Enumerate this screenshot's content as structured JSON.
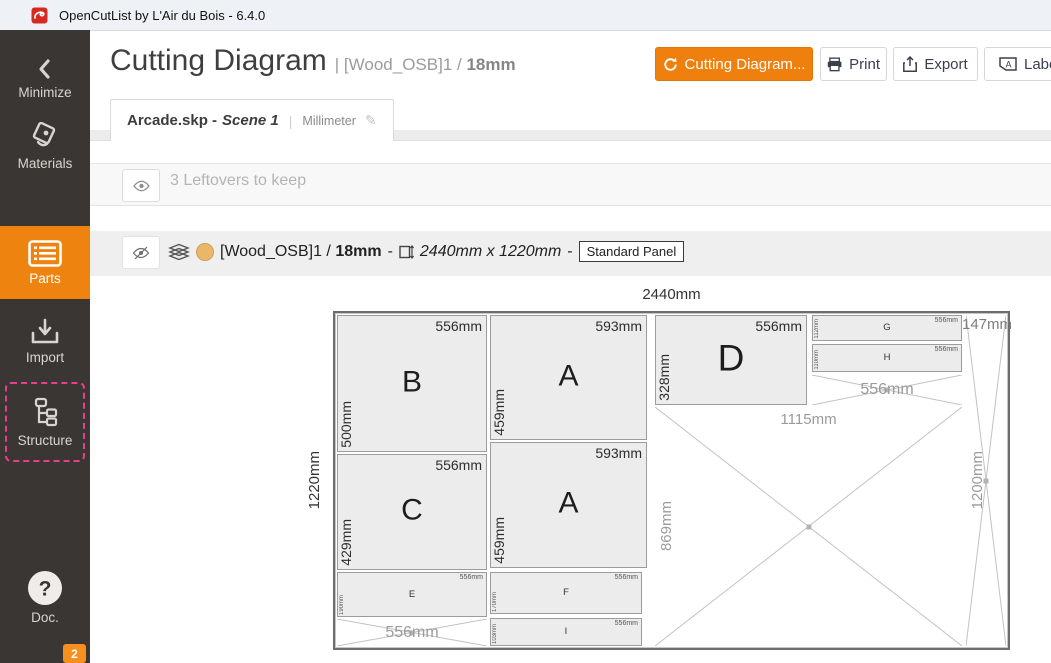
{
  "window": {
    "title": "OpenCutList by L'Air du Bois - 6.4.0"
  },
  "sidebar": {
    "items": [
      {
        "id": "minimize",
        "label": "Minimize"
      },
      {
        "id": "materials",
        "label": "Materials"
      },
      {
        "id": "parts",
        "label": "Parts"
      },
      {
        "id": "import",
        "label": "Import"
      },
      {
        "id": "structure",
        "label": "Structure"
      },
      {
        "id": "doc",
        "label": "Doc."
      }
    ],
    "badge": "2"
  },
  "header": {
    "title": "Cutting Diagram",
    "sep": "|",
    "subtitle": "[Wood_OSB]1 /",
    "subtitle_bold": "18mm",
    "buttons": {
      "cutting_diagram": "Cutting Diagram...",
      "print": "Print",
      "export": "Export",
      "labels": "Labels"
    }
  },
  "tab": {
    "file": "Arcade.skp -",
    "scene": "Scene 1",
    "sep": "|",
    "unit": "Millimeter"
  },
  "leftovers_bar": {
    "text": "3 Leftovers to keep"
  },
  "sheet_bar": {
    "material": "[Wood_OSB]1 /",
    "thickness": "18mm",
    "dash": "-",
    "size": "2440mm x 1220mm",
    "type_badge": "Standard Panel",
    "swatch_color": "#eab76a"
  },
  "colors": {
    "accent": "#ef8310",
    "structure_highlight": "#e83e8c"
  },
  "diagram": {
    "width_label": "2440mm",
    "height_label": "1220mm",
    "parts": [
      {
        "letter": "B",
        "top": "556mm",
        "side": "500mm",
        "size": "lg",
        "x": 2,
        "y": 2,
        "w": 150,
        "h": 137
      },
      {
        "letter": "C",
        "top": "556mm",
        "side": "429mm",
        "size": "lg",
        "x": 2,
        "y": 141,
        "w": 150,
        "h": 116
      },
      {
        "letter": "E",
        "top": "556mm",
        "side": "190mm",
        "size": "sm",
        "x": 2,
        "y": 259,
        "w": 150,
        "h": 45
      },
      {
        "letter": "A",
        "top": "593mm",
        "side": "459mm",
        "size": "lg",
        "x": 155,
        "y": 2,
        "w": 157,
        "h": 125
      },
      {
        "letter": "A",
        "top": "593mm",
        "side": "459mm",
        "size": "lg",
        "x": 155,
        "y": 129,
        "w": 157,
        "h": 126
      },
      {
        "letter": "F",
        "top": "556mm",
        "side": "170mm",
        "size": "sm",
        "x": 155,
        "y": 259,
        "w": 152,
        "h": 42
      },
      {
        "letter": "I",
        "top": "556mm",
        "side": "103mm",
        "size": "sm",
        "x": 155,
        "y": 305,
        "w": 152,
        "h": 28
      },
      {
        "letter": "D",
        "top": "556mm",
        "side": "328mm",
        "size": "lg xl",
        "x": 320,
        "y": 2,
        "w": 152,
        "h": 90
      },
      {
        "letter": "G",
        "top": "556mm",
        "side": "112mm",
        "size": "sm",
        "x": 477,
        "y": 2,
        "w": 150,
        "h": 26
      },
      {
        "letter": "H",
        "top": "556mm",
        "side": "110mm",
        "size": "sm",
        "x": 477,
        "y": 31,
        "w": 150,
        "h": 28
      }
    ],
    "leftovers": [
      {
        "w_label": "556mm",
        "w_pos": "center",
        "x": 2,
        "y": 306,
        "w": 150,
        "h": 27
      },
      {
        "w_label": "556mm",
        "w_pos": "center",
        "x": 477,
        "y": 62,
        "w": 150,
        "h": 30
      },
      {
        "w_label": "1115mm",
        "w_pos": "top",
        "h_label": "869mm",
        "x": 320,
        "y": 94,
        "w": 307,
        "h": 239
      },
      {
        "w_label": "147mm",
        "w_pos": "topedge",
        "h_label": "1200mm",
        "x": 631,
        "y": 2,
        "w": 40,
        "h": 331
      }
    ]
  }
}
